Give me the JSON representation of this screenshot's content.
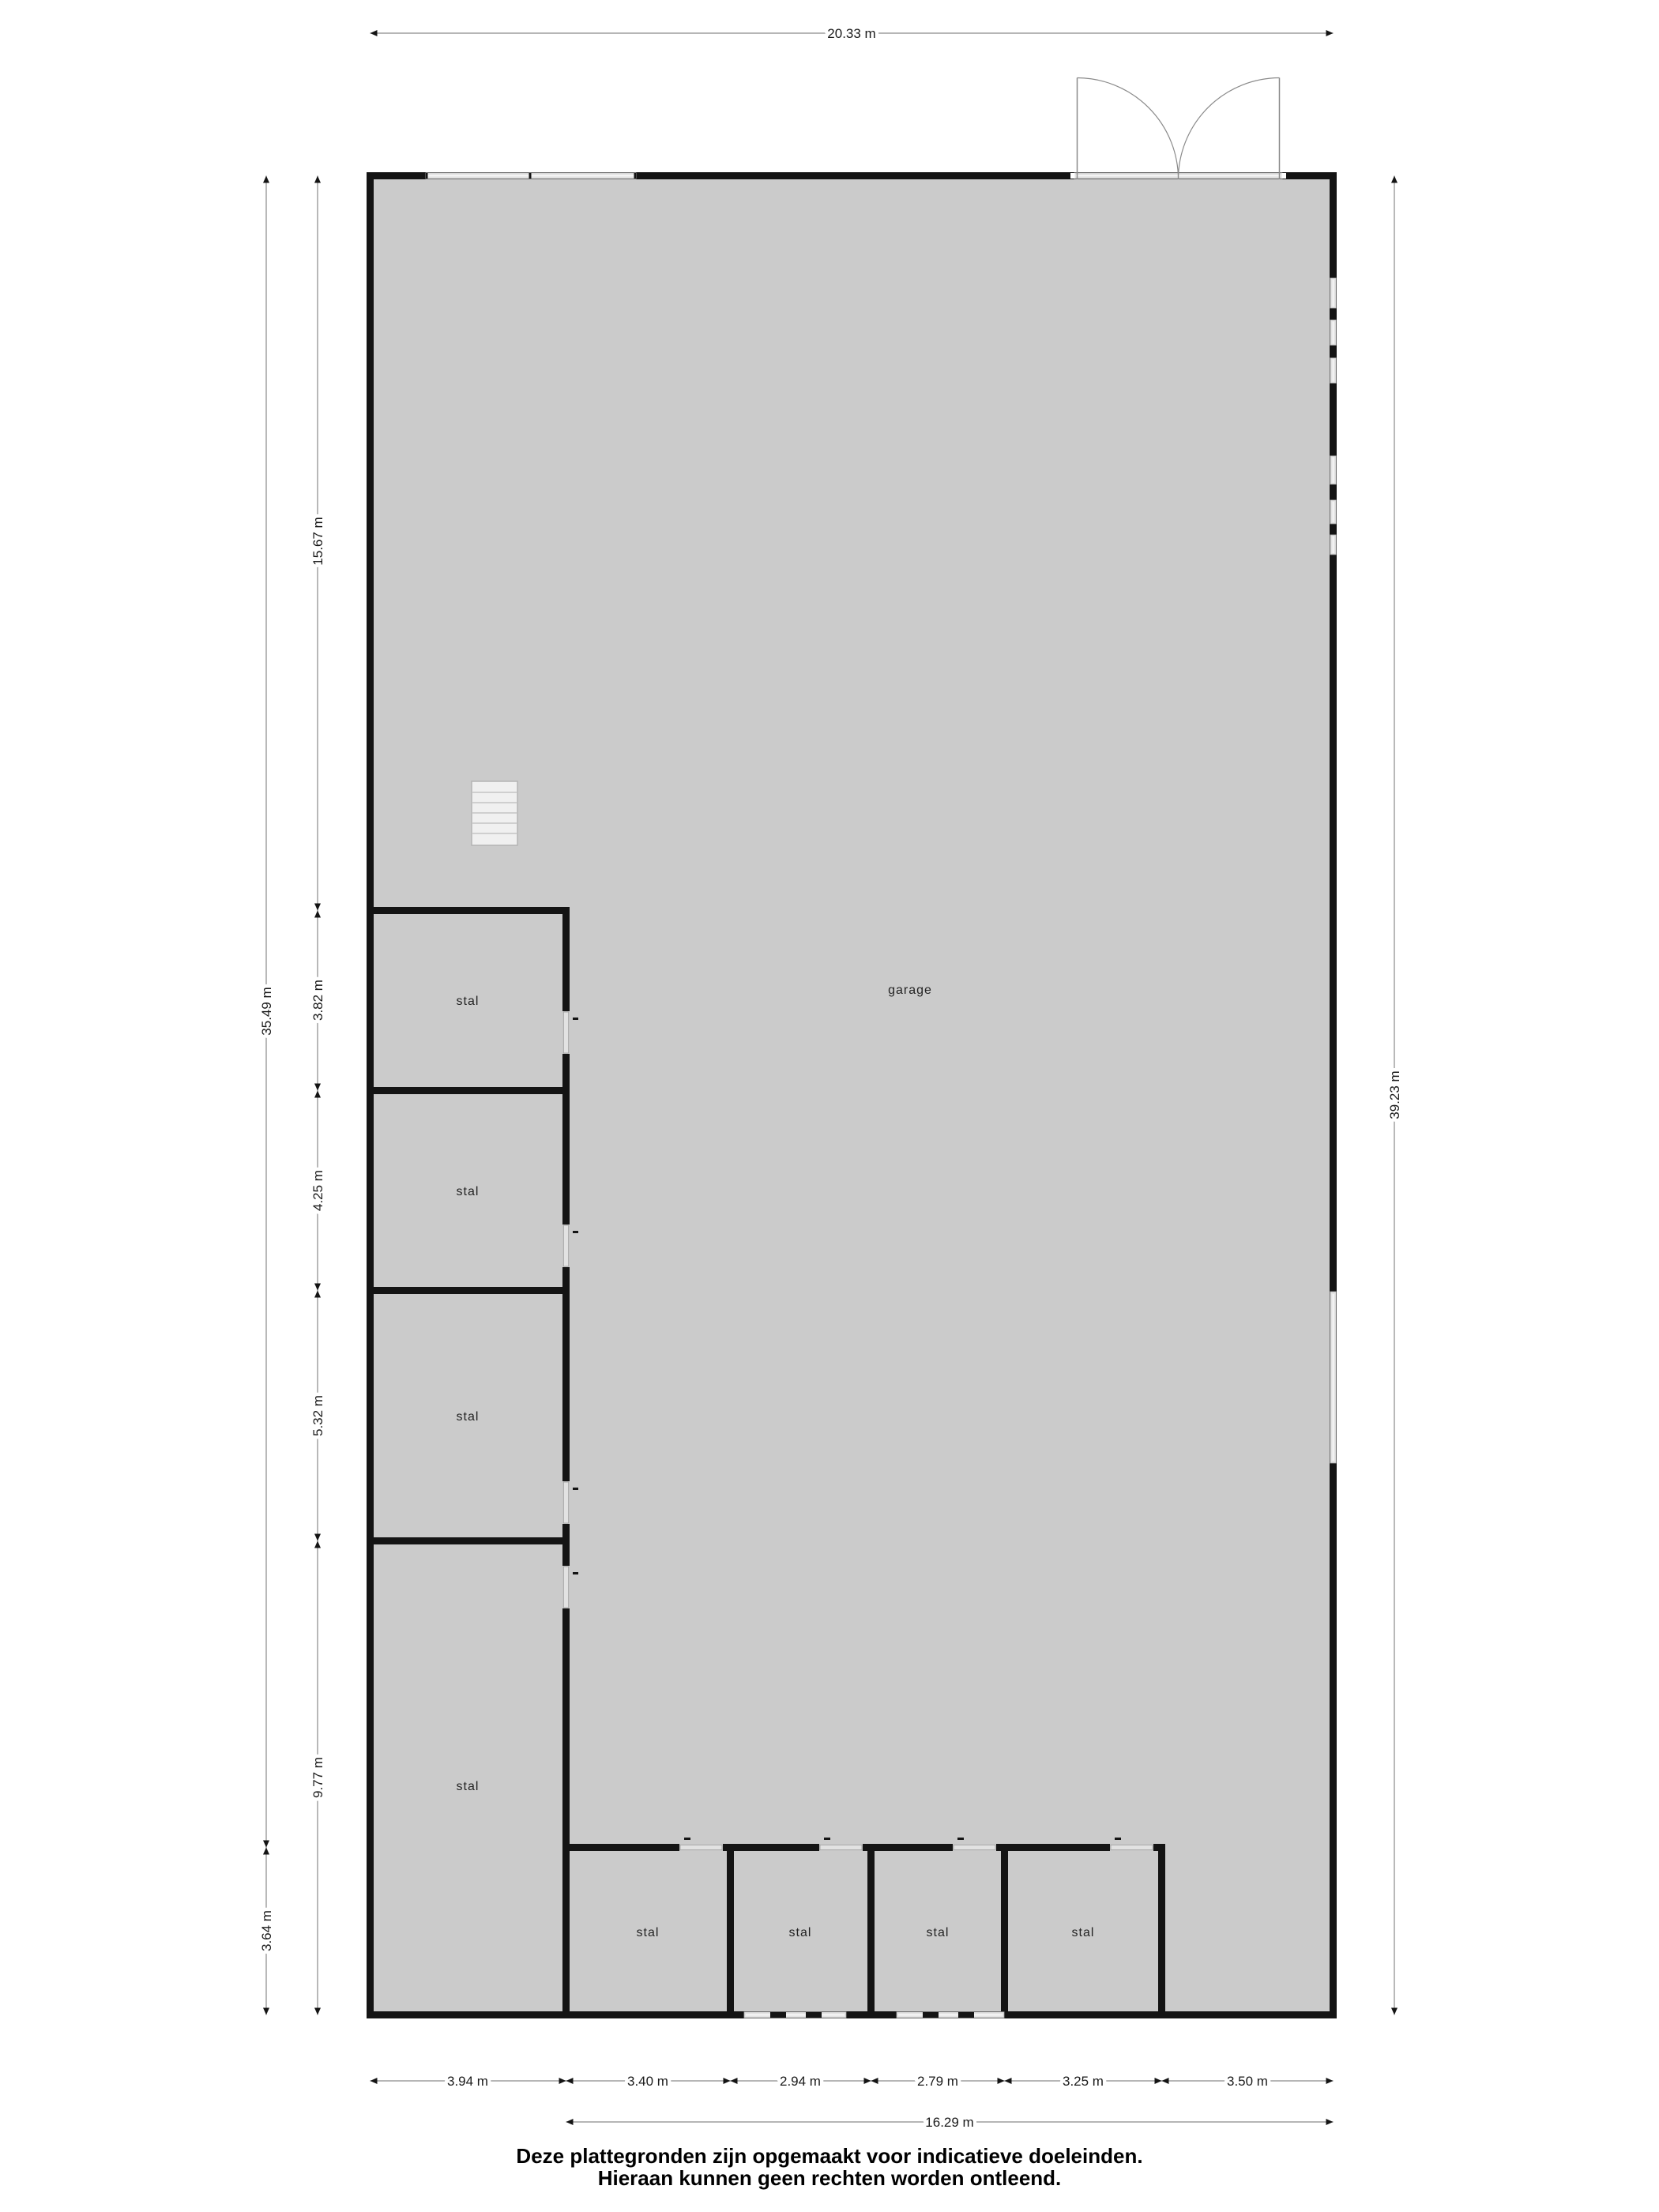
{
  "plan": {
    "room_labels": {
      "garage": "garage",
      "stal": "stal"
    }
  },
  "dimensions": {
    "top_width": "20.33 m",
    "right_height": "39.23 m",
    "left_outer": [
      "35.49 m",
      "3.64 m"
    ],
    "left_inner": [
      "15.67 m",
      "3.82 m",
      "4.25 m",
      "5.32 m",
      "9.77 m"
    ],
    "bottom_segments": [
      "3.94 m",
      "3.40 m",
      "2.94 m",
      "2.79 m",
      "3.25 m",
      "3.50 m"
    ],
    "bottom_total": "16.29 m"
  },
  "footer": {
    "line1": "Deze plattegronden zijn opgemaakt voor indicatieve doeleinden.",
    "line2": "Hieraan kunnen geen rechten worden ontleend."
  },
  "colors": {
    "floor": "#cbcbcb",
    "wall": "#141414",
    "window": "#e4e4e4",
    "dimension_line": "#8a8a8a",
    "text": "#1a1a1a"
  }
}
